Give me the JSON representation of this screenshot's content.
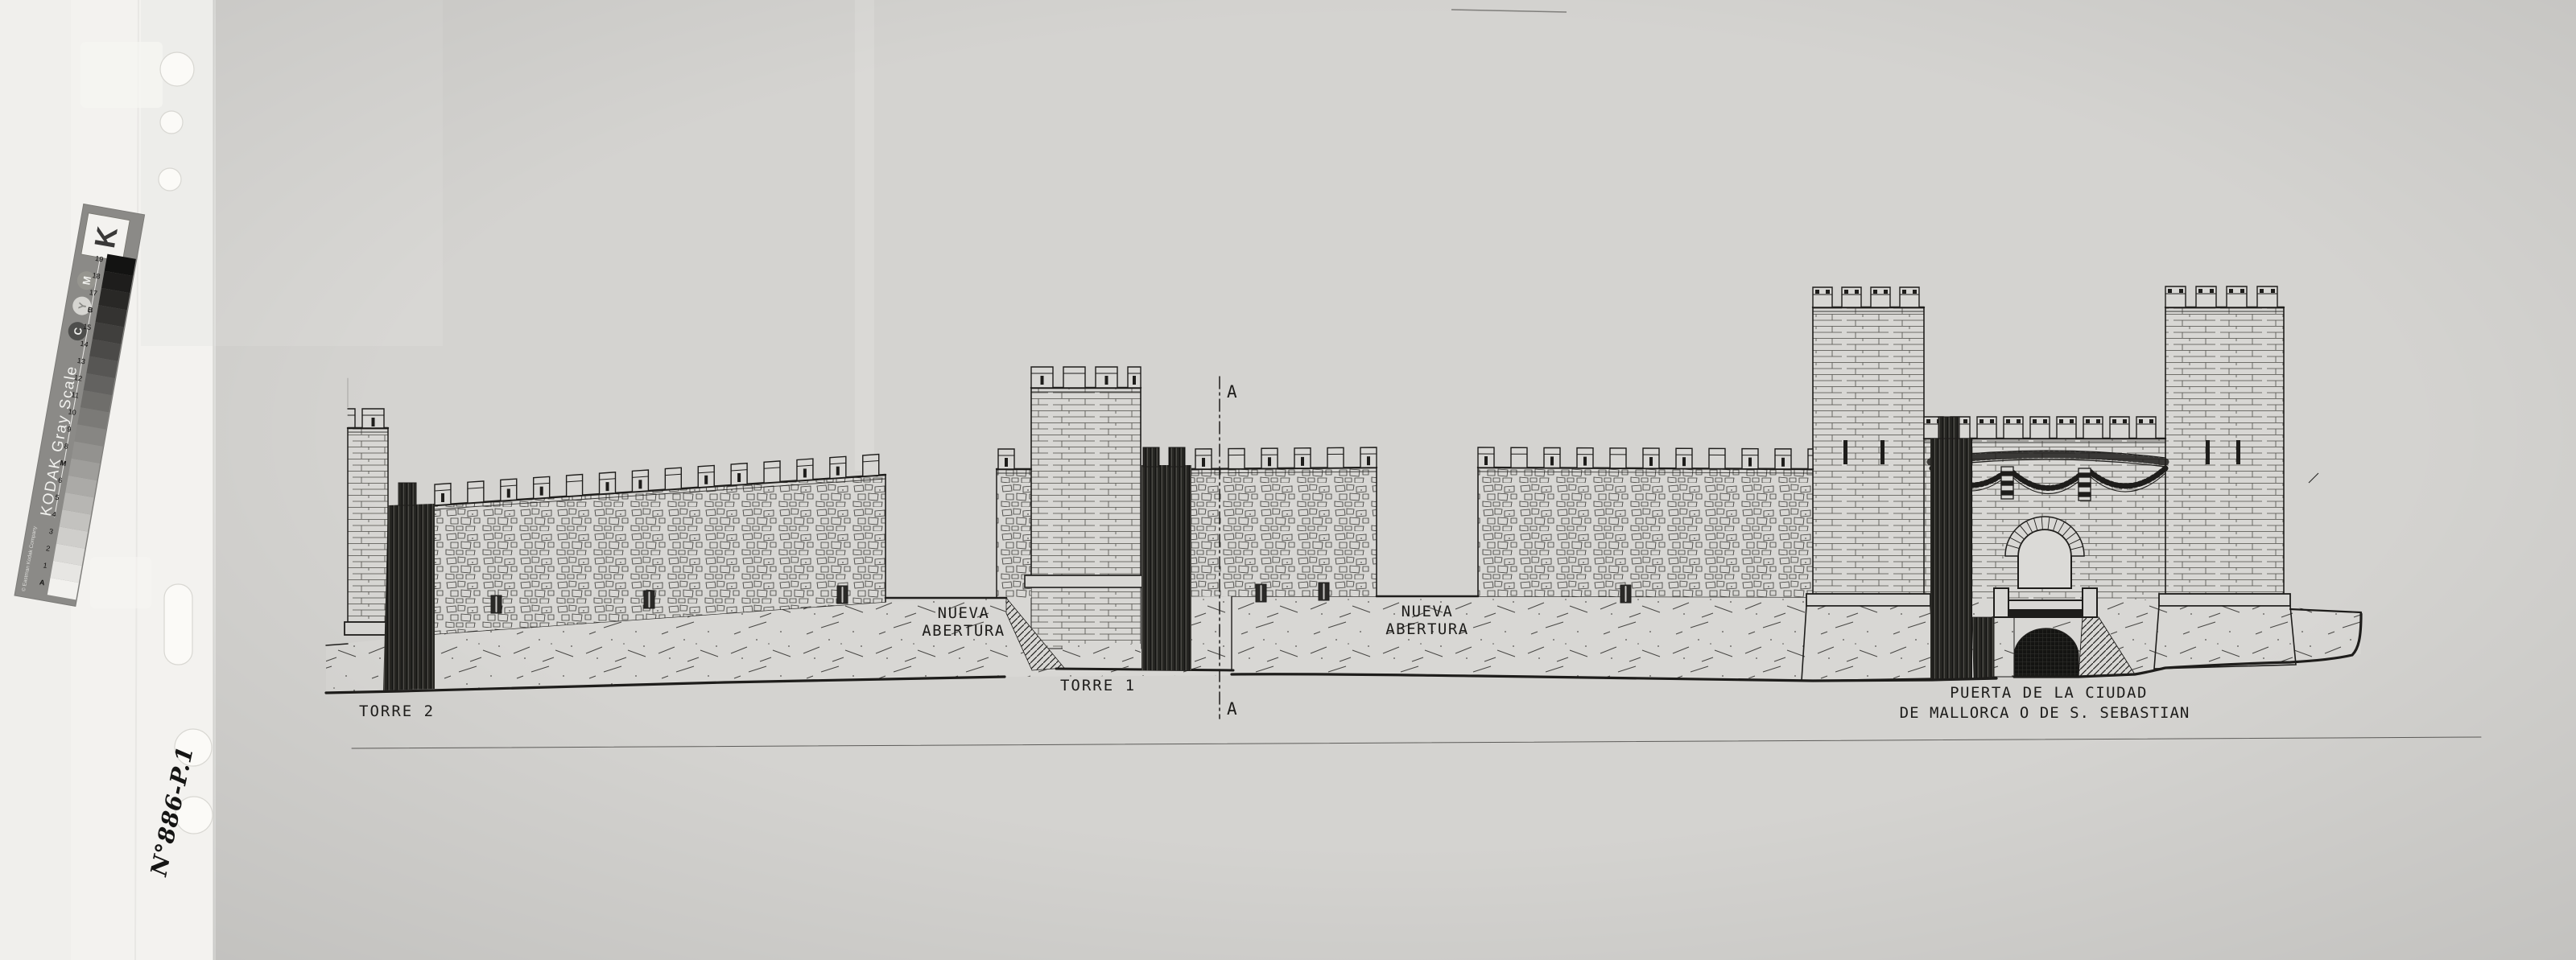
{
  "photo": {
    "background_color": "#d4d3d0",
    "paper_color": "#d8d7d4",
    "ink_color": "#1e1d1b",
    "backing_color": "#f0efec"
  },
  "grayscale_card": {
    "brand": "KODAK Gray Scale",
    "copyright": "© Eastman Kodak Company",
    "logo_letter": "K",
    "steps": [
      "A",
      "1",
      "2",
      "3",
      "4",
      "5",
      "6",
      "M",
      "8",
      "9",
      "10",
      "11",
      "12",
      "13",
      "14",
      "15",
      "B",
      "17",
      "18",
      "19"
    ],
    "step_colors": [
      "#f2f1ee",
      "#e7e6e3",
      "#dbdad7",
      "#cfcecb",
      "#c3c2bf",
      "#b7b6b3",
      "#abaaa7",
      "#9f9e9b",
      "#93928f",
      "#878683",
      "#7b7a77",
      "#6f6e6b",
      "#636260",
      "#575654",
      "#4b4a48",
      "#403f3d",
      "#343331",
      "#292826",
      "#1e1d1c",
      "#131312"
    ],
    "dots": [
      "C",
      "Y",
      "M"
    ]
  },
  "handwritten_note": {
    "text": "N°886-P.1"
  },
  "drawing": {
    "labels": {
      "torre2": "TORRE 2",
      "torre1": "TORRE 1",
      "nueva_abertura_1": [
        "NUEVA",
        "ABERTURA"
      ],
      "nueva_abertura_2": [
        "NUEVA",
        "ABERTURA"
      ],
      "gate": [
        "PUERTA DE LA CIUDAD",
        "DE MALLORCA O DE S. SEBASTIAN"
      ],
      "section_marker": "A"
    }
  }
}
